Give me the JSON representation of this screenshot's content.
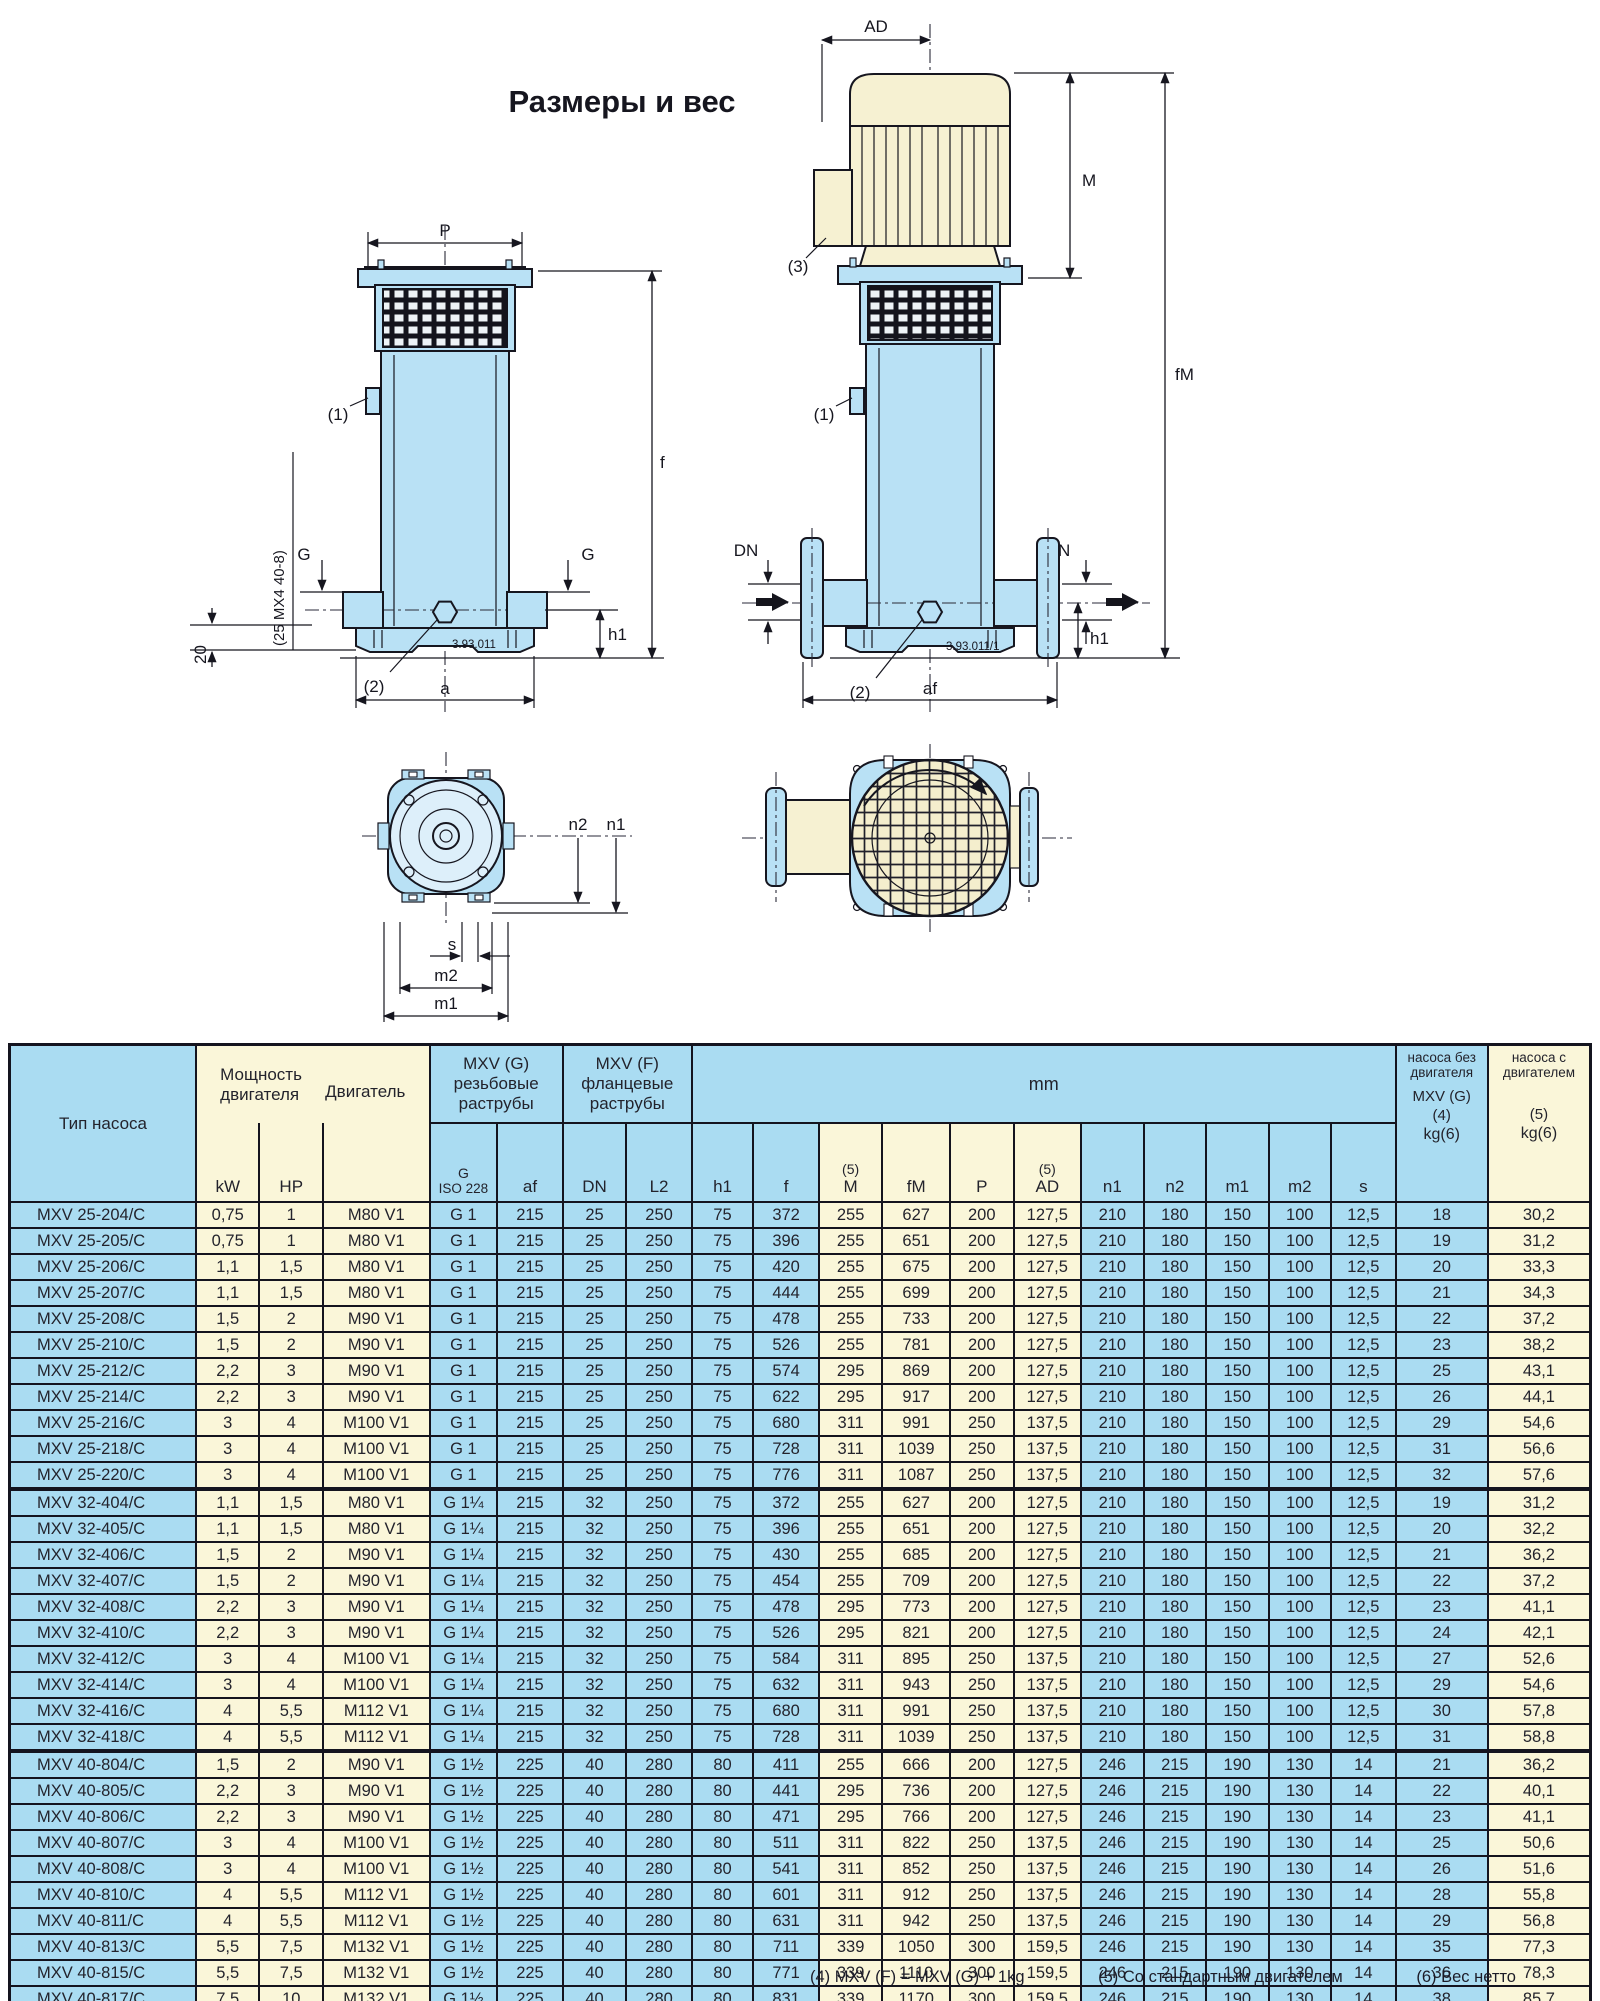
{
  "title": "Размеры и вес",
  "appearance": {
    "table_blue": "#aadcf2",
    "table_cream": "#faf6d9",
    "drawing_blue": "#b9e1f5",
    "drawing_cream": "#f6f1d2",
    "line_color": "#14141f"
  },
  "drawings": {
    "labels": {
      "p": "P",
      "f": "f",
      "g": "G",
      "h1": "h1",
      "a": "a",
      "d20": "20",
      "note1": "(1)",
      "note2": "(2)",
      "note3": "(3)",
      "side": "(25 MX4 40-8)",
      "code1": "3.93.011",
      "ad": "AD",
      "m": "M",
      "fm": "fM",
      "dn": "DN",
      "af": "af",
      "code2": "3.93.011/1",
      "n1": "n1",
      "n2": "n2",
      "s": "s",
      "m1": "m1",
      "m2": "m2"
    }
  },
  "table": {
    "header": {
      "pump_type": "Тип насоса",
      "motor_power": "Мощность\nдвигателя",
      "motor": "Двигатель",
      "mxv_g": "MXV (G)\nрезьбовые\nраструбы",
      "mxv_f": "MXV (F)\nфланцевые\nраструбы",
      "mm": "mm",
      "w1_top": "насоса без\nдвигателя",
      "w1_mid": "MXV (G)",
      "w1_note": "(4)",
      "w1_kg": "kg(6)",
      "w2_top": "насоса с\nдвигателем",
      "w2_note": "(5)",
      "w2_kg": "kg(6)"
    },
    "col_keys": [
      "type",
      "kw",
      "hp",
      "motor",
      "g_iso228",
      "af",
      "dn",
      "l2",
      "h1",
      "f",
      "m",
      "fm",
      "p",
      "ad",
      "n1",
      "n2",
      "m1",
      "m2",
      "s",
      "kg_pump_only",
      "kg_with_motor"
    ],
    "units": [
      {
        "key": "kw",
        "label": "kW"
      },
      {
        "key": "hp",
        "label": "HP"
      },
      {
        "key": "motor",
        "label": ""
      },
      {
        "key": "g",
        "sup": "G",
        "label": "ISO 228",
        "small": true
      },
      {
        "key": "af",
        "label": "af"
      },
      {
        "key": "dn",
        "label": "DN"
      },
      {
        "key": "l2",
        "label": "L2"
      },
      {
        "key": "h1",
        "label": "h1"
      },
      {
        "key": "f",
        "label": "f"
      },
      {
        "key": "m",
        "sup": "(5)",
        "label": "M"
      },
      {
        "key": "fm",
        "label": "fM"
      },
      {
        "key": "p",
        "label": "P"
      },
      {
        "key": "ad",
        "sup": "(5)",
        "label": "AD"
      },
      {
        "key": "n1",
        "label": "n1"
      },
      {
        "key": "n2",
        "label": "n2"
      },
      {
        "key": "m1",
        "label": "m1"
      },
      {
        "key": "m2",
        "label": "m2"
      },
      {
        "key": "s",
        "label": "s"
      }
    ],
    "groups": [
      {
        "rows": [
          [
            "MXV 25-204/C",
            "0,75",
            "1",
            "M80 V1",
            "G 1",
            "215",
            "25",
            "250",
            "75",
            "372",
            "255",
            "627",
            "200",
            "127,5",
            "210",
            "180",
            "150",
            "100",
            "12,5",
            "18",
            "30,2"
          ],
          [
            "MXV 25-205/C",
            "0,75",
            "1",
            "M80 V1",
            "G 1",
            "215",
            "25",
            "250",
            "75",
            "396",
            "255",
            "651",
            "200",
            "127,5",
            "210",
            "180",
            "150",
            "100",
            "12,5",
            "19",
            "31,2"
          ],
          [
            "MXV 25-206/C",
            "1,1",
            "1,5",
            "M80 V1",
            "G 1",
            "215",
            "25",
            "250",
            "75",
            "420",
            "255",
            "675",
            "200",
            "127,5",
            "210",
            "180",
            "150",
            "100",
            "12,5",
            "20",
            "33,3"
          ],
          [
            "MXV 25-207/C",
            "1,1",
            "1,5",
            "M80 V1",
            "G 1",
            "215",
            "25",
            "250",
            "75",
            "444",
            "255",
            "699",
            "200",
            "127,5",
            "210",
            "180",
            "150",
            "100",
            "12,5",
            "21",
            "34,3"
          ],
          [
            "MXV 25-208/C",
            "1,5",
            "2",
            "M90 V1",
            "G 1",
            "215",
            "25",
            "250",
            "75",
            "478",
            "255",
            "733",
            "200",
            "127,5",
            "210",
            "180",
            "150",
            "100",
            "12,5",
            "22",
            "37,2"
          ],
          [
            "MXV 25-210/C",
            "1,5",
            "2",
            "M90 V1",
            "G 1",
            "215",
            "25",
            "250",
            "75",
            "526",
            "255",
            "781",
            "200",
            "127,5",
            "210",
            "180",
            "150",
            "100",
            "12,5",
            "23",
            "38,2"
          ],
          [
            "MXV 25-212/C",
            "2,2",
            "3",
            "M90 V1",
            "G 1",
            "215",
            "25",
            "250",
            "75",
            "574",
            "295",
            "869",
            "200",
            "127,5",
            "210",
            "180",
            "150",
            "100",
            "12,5",
            "25",
            "43,1"
          ],
          [
            "MXV 25-214/C",
            "2,2",
            "3",
            "M90 V1",
            "G 1",
            "215",
            "25",
            "250",
            "75",
            "622",
            "295",
            "917",
            "200",
            "127,5",
            "210",
            "180",
            "150",
            "100",
            "12,5",
            "26",
            "44,1"
          ],
          [
            "MXV 25-216/C",
            "3",
            "4",
            "M100 V1",
            "G 1",
            "215",
            "25",
            "250",
            "75",
            "680",
            "311",
            "991",
            "250",
            "137,5",
            "210",
            "180",
            "150",
            "100",
            "12,5",
            "29",
            "54,6"
          ],
          [
            "MXV 25-218/C",
            "3",
            "4",
            "M100 V1",
            "G 1",
            "215",
            "25",
            "250",
            "75",
            "728",
            "311",
            "1039",
            "250",
            "137,5",
            "210",
            "180",
            "150",
            "100",
            "12,5",
            "31",
            "56,6"
          ],
          [
            "MXV 25-220/C",
            "3",
            "4",
            "M100 V1",
            "G 1",
            "215",
            "25",
            "250",
            "75",
            "776",
            "311",
            "1087",
            "250",
            "137,5",
            "210",
            "180",
            "150",
            "100",
            "12,5",
            "32",
            "57,6"
          ]
        ]
      },
      {
        "rows": [
          [
            "MXV 32-404/C",
            "1,1",
            "1,5",
            "M80 V1",
            "G 1¼",
            "215",
            "32",
            "250",
            "75",
            "372",
            "255",
            "627",
            "200",
            "127,5",
            "210",
            "180",
            "150",
            "100",
            "12,5",
            "19",
            "31,2"
          ],
          [
            "MXV 32-405/C",
            "1,1",
            "1,5",
            "M80 V1",
            "G 1¼",
            "215",
            "32",
            "250",
            "75",
            "396",
            "255",
            "651",
            "200",
            "127,5",
            "210",
            "180",
            "150",
            "100",
            "12,5",
            "20",
            "32,2"
          ],
          [
            "MXV 32-406/C",
            "1,5",
            "2",
            "M90 V1",
            "G 1¼",
            "215",
            "32",
            "250",
            "75",
            "430",
            "255",
            "685",
            "200",
            "127,5",
            "210",
            "180",
            "150",
            "100",
            "12,5",
            "21",
            "36,2"
          ],
          [
            "MXV 32-407/C",
            "1,5",
            "2",
            "M90 V1",
            "G 1¼",
            "215",
            "32",
            "250",
            "75",
            "454",
            "255",
            "709",
            "200",
            "127,5",
            "210",
            "180",
            "150",
            "100",
            "12,5",
            "22",
            "37,2"
          ],
          [
            "MXV 32-408/C",
            "2,2",
            "3",
            "M90 V1",
            "G 1¼",
            "215",
            "32",
            "250",
            "75",
            "478",
            "295",
            "773",
            "200",
            "127,5",
            "210",
            "180",
            "150",
            "100",
            "12,5",
            "23",
            "41,1"
          ],
          [
            "MXV 32-410/C",
            "2,2",
            "3",
            "M90 V1",
            "G 1¼",
            "215",
            "32",
            "250",
            "75",
            "526",
            "295",
            "821",
            "200",
            "127,5",
            "210",
            "180",
            "150",
            "100",
            "12,5",
            "24",
            "42,1"
          ],
          [
            "MXV 32-412/C",
            "3",
            "4",
            "M100 V1",
            "G 1¼",
            "215",
            "32",
            "250",
            "75",
            "584",
            "311",
            "895",
            "250",
            "137,5",
            "210",
            "180",
            "150",
            "100",
            "12,5",
            "27",
            "52,6"
          ],
          [
            "MXV 32-414/C",
            "3",
            "4",
            "M100 V1",
            "G 1¼",
            "215",
            "32",
            "250",
            "75",
            "632",
            "311",
            "943",
            "250",
            "137,5",
            "210",
            "180",
            "150",
            "100",
            "12,5",
            "29",
            "54,6"
          ],
          [
            "MXV 32-416/C",
            "4",
            "5,5",
            "M112 V1",
            "G 1¼",
            "215",
            "32",
            "250",
            "75",
            "680",
            "311",
            "991",
            "250",
            "137,5",
            "210",
            "180",
            "150",
            "100",
            "12,5",
            "30",
            "57,8"
          ],
          [
            "MXV 32-418/C",
            "4",
            "5,5",
            "M112 V1",
            "G 1¼",
            "215",
            "32",
            "250",
            "75",
            "728",
            "311",
            "1039",
            "250",
            "137,5",
            "210",
            "180",
            "150",
            "100",
            "12,5",
            "31",
            "58,8"
          ]
        ]
      },
      {
        "rows": [
          [
            "MXV 40-804/C",
            "1,5",
            "2",
            "M90 V1",
            "G 1½",
            "225",
            "40",
            "280",
            "80",
            "411",
            "255",
            "666",
            "200",
            "127,5",
            "246",
            "215",
            "190",
            "130",
            "14",
            "21",
            "36,2"
          ],
          [
            "MXV 40-805/C",
            "2,2",
            "3",
            "M90 V1",
            "G 1½",
            "225",
            "40",
            "280",
            "80",
            "441",
            "295",
            "736",
            "200",
            "127,5",
            "246",
            "215",
            "190",
            "130",
            "14",
            "22",
            "40,1"
          ],
          [
            "MXV 40-806/C",
            "2,2",
            "3",
            "M90 V1",
            "G 1½",
            "225",
            "40",
            "280",
            "80",
            "471",
            "295",
            "766",
            "200",
            "127,5",
            "246",
            "215",
            "190",
            "130",
            "14",
            "23",
            "41,1"
          ],
          [
            "MXV 40-807/C",
            "3",
            "4",
            "M100 V1",
            "G 1½",
            "225",
            "40",
            "280",
            "80",
            "511",
            "311",
            "822",
            "250",
            "137,5",
            "246",
            "215",
            "190",
            "130",
            "14",
            "25",
            "50,6"
          ],
          [
            "MXV 40-808/C",
            "3",
            "4",
            "M100 V1",
            "G 1½",
            "225",
            "40",
            "280",
            "80",
            "541",
            "311",
            "852",
            "250",
            "137,5",
            "246",
            "215",
            "190",
            "130",
            "14",
            "26",
            "51,6"
          ],
          [
            "MXV 40-810/C",
            "4",
            "5,5",
            "M112 V1",
            "G 1½",
            "225",
            "40",
            "280",
            "80",
            "601",
            "311",
            "912",
            "250",
            "137,5",
            "246",
            "215",
            "190",
            "130",
            "14",
            "28",
            "55,8"
          ],
          [
            "MXV 40-811/C",
            "4",
            "5,5",
            "M112 V1",
            "G 1½",
            "225",
            "40",
            "280",
            "80",
            "631",
            "311",
            "942",
            "250",
            "137,5",
            "246",
            "215",
            "190",
            "130",
            "14",
            "29",
            "56,8"
          ],
          [
            "MXV 40-813/C",
            "5,5",
            "7,5",
            "M132 V1",
            "G 1½",
            "225",
            "40",
            "280",
            "80",
            "711",
            "339",
            "1050",
            "300",
            "159,5",
            "246",
            "215",
            "190",
            "130",
            "14",
            "35",
            "77,3"
          ],
          [
            "MXV 40-815/C",
            "5,5",
            "7,5",
            "M132 V1",
            "G 1½",
            "225",
            "40",
            "280",
            "80",
            "771",
            "339",
            "1110",
            "300",
            "159,5",
            "246",
            "215",
            "190",
            "130",
            "14",
            "36",
            "78,3"
          ],
          [
            "MXV 40-817/C",
            "7,5",
            "10",
            "M132 V1",
            "G 1½",
            "225",
            "40",
            "280",
            "80",
            "831",
            "339",
            "1170",
            "300",
            "159,5",
            "246",
            "215",
            "190",
            "130",
            "14",
            "38",
            "85,7"
          ],
          [
            "MXV 40-819/C",
            "7,5",
            "10",
            "M132 V1",
            "G 1½",
            "225",
            "40",
            "280",
            "80",
            "891",
            "339",
            "1230",
            "300",
            "159,5",
            "246",
            "215",
            "190",
            "130",
            "14",
            "39",
            "86,7"
          ]
        ]
      }
    ],
    "footnotes": [
      "(4) MXV (F) = MXV (G) + 1kg",
      "(5) Со стандартным двигателем",
      "(6) Вес нетто"
    ]
  }
}
